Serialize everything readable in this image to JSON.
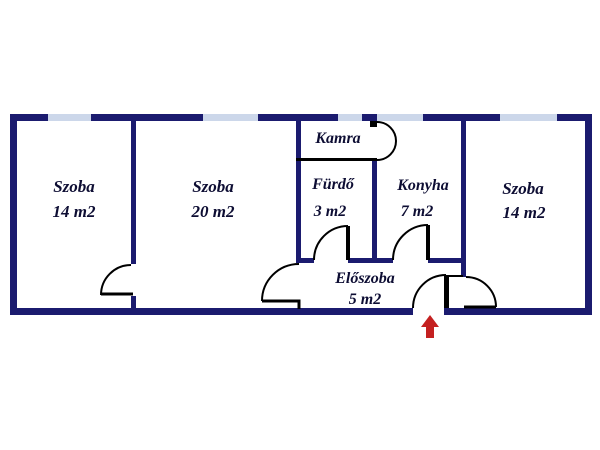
{
  "plan": {
    "rooms": {
      "szoba_left": {
        "name": "Szoba",
        "area": "14 m2"
      },
      "szoba_mid": {
        "name": "Szoba",
        "area": "20 m2"
      },
      "kamra": {
        "name": "Kamra"
      },
      "furdo": {
        "name": "Fürdő",
        "area": "3 m2"
      },
      "konyha": {
        "name": "Konyha",
        "area": "7 m2"
      },
      "szoba_right": {
        "name": "Szoba",
        "area": "14 m2"
      },
      "eloszoba": {
        "name": "Előszoba",
        "area": "5 m2"
      }
    },
    "icons": {
      "entrance_arrow": "red-up-arrow-at-main-entrance"
    }
  },
  "colors": {
    "wall": "#1b1b6f",
    "window": "#ccd7ea",
    "door": "#000000",
    "arrow": "#c42020",
    "bg": "#ffffff",
    "text": "#0d0d33"
  }
}
